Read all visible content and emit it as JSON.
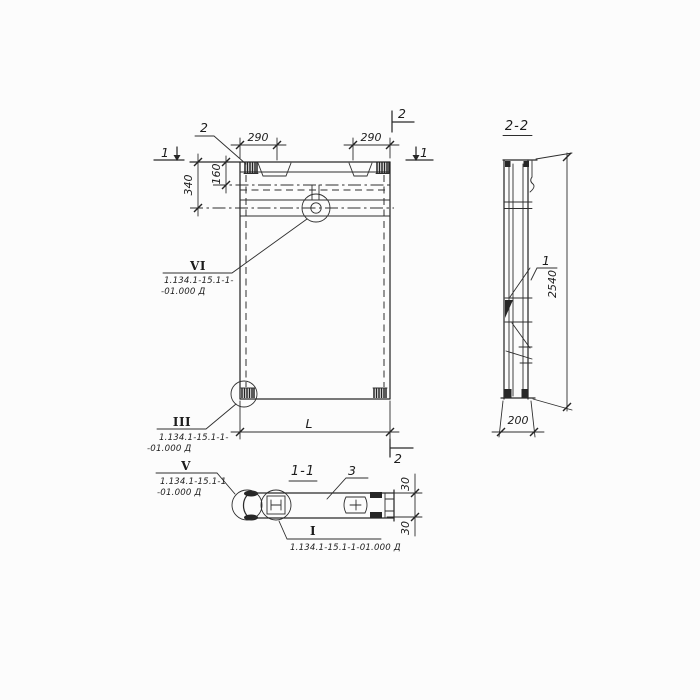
{
  "drawing": {
    "colors": {
      "ink": "#2a2a2a",
      "paper": "#fcfcfc"
    },
    "elevation": {
      "dim_290_left": "290",
      "dim_290_right": "290",
      "dim_340": "340",
      "dim_160": "160",
      "dim_length": "L",
      "marker_section1_left": "1",
      "marker_section1_right": "1",
      "marker_section2_top": "2",
      "marker_section2_bottom": "2",
      "pos_label_2": "2",
      "detail_vi": {
        "numeral": "VI",
        "ref_line1": "1.134.1-15.1-1-",
        "ref_line2": "-01.000 Д"
      },
      "detail_iii": {
        "numeral": "III",
        "ref_line1": "1.134.1-15.1-1-",
        "ref_line2": "-01.000 Д"
      }
    },
    "section_2_2": {
      "title": "2-2",
      "dim_height": "2540",
      "dim_width": "200",
      "pos_label_1": "1"
    },
    "section_1_1": {
      "title": "1-1",
      "pos_label_3": "3",
      "dim_30_top": "30",
      "dim_30_bottom": "30",
      "detail_v": {
        "numeral": "V",
        "ref_line1": "1.134.1-15.1-1",
        "ref_line2": "-01.000 Д"
      },
      "detail_i": {
        "numeral": "I",
        "ref_line1": "1.134.1-15.1-1-01.000 Д"
      }
    }
  }
}
